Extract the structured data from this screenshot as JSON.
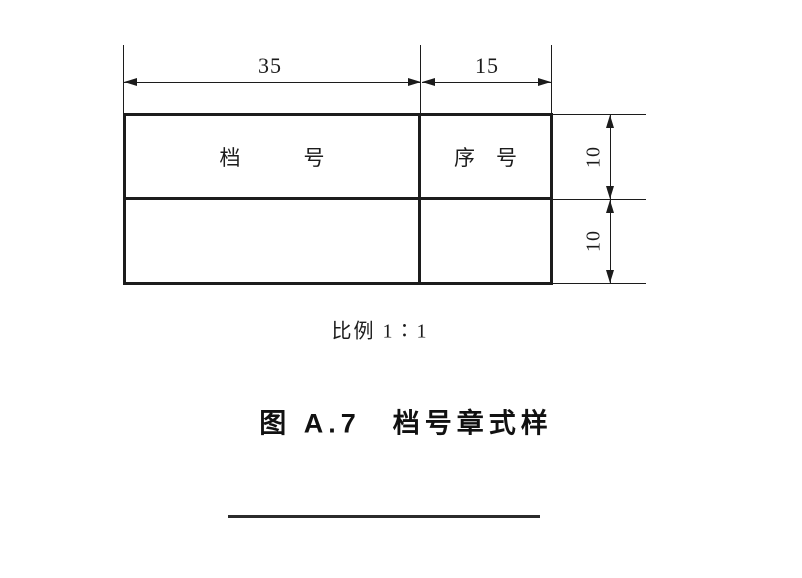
{
  "page": {
    "background": "#ffffff",
    "line_color": "#1c1c1c"
  },
  "drawing": {
    "dim_width_left": "35",
    "dim_width_right": "15",
    "dim_height_top": "10",
    "dim_height_bottom": "10",
    "stamp": {
      "header_left": "档　　　号",
      "header_right": "序　号",
      "body_left": "",
      "body_right": ""
    },
    "scale_note": "比例 1∶1",
    "caption": "图 A.7　档号章式样"
  }
}
